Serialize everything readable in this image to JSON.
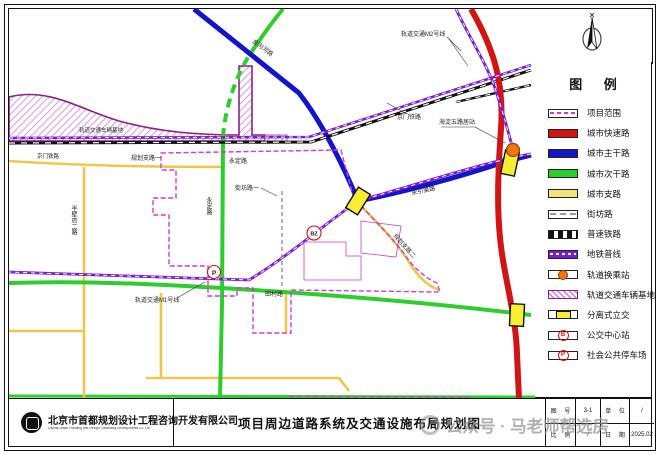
{
  "legend": {
    "title": "图 例",
    "items": [
      {
        "label": "项目范围"
      },
      {
        "label": "城市快速路"
      },
      {
        "label": "城市主干路"
      },
      {
        "label": "城市次干路"
      },
      {
        "label": "城市支路"
      },
      {
        "label": "街坊路"
      },
      {
        "label": "普速铁路"
      },
      {
        "label": "地铁普线"
      },
      {
        "label": "轨道换乘站"
      },
      {
        "label": "轨道交通车辆基地"
      },
      {
        "label": "分离式立交"
      },
      {
        "label": "公交中心站"
      },
      {
        "label": "社会公共停车场"
      }
    ],
    "bus_glyph": "B",
    "parking_glyph": "P"
  },
  "map": {
    "labels": {
      "depot": "轨道交通车辆基地",
      "railway_west": "京门铁路",
      "railway_east": "京门铁路",
      "metro_m2": "轨道交通M2号线",
      "station": "海淀五路居站",
      "jingouhe": "金沟河路",
      "yongyinqu": "永引渠路",
      "branch1": "规划支路一",
      "yongding_h": "永定路",
      "jiefang1": "街坊路一",
      "yongding_v": "永定路",
      "banbidian": "半壁店二路",
      "metro_m1": "轨道交通M1号线",
      "tiancun": "田村路",
      "branch2": "规划支路二",
      "bz": "BZ",
      "p": "P"
    }
  },
  "title_block": {
    "company_cn": "北京市首都规划设计工程咨询开发有限公司",
    "company_en": "Capital Urban Planning and Design Consulting Developments Co.,Ltd",
    "drawing_title": "项目周边道路系统及交通设施布局规划图",
    "fields": {
      "sheet_no_label": "图 号",
      "sheet_no": "3-1",
      "unit_label": "单 位",
      "unit": "/",
      "scale_label": "比 例",
      "scale": "/",
      "date_label": "日 期",
      "date": "2025.02"
    }
  },
  "watermark": {
    "text": "公众号 · 马老师帮选房"
  },
  "colors": {
    "expressway": "#d11414",
    "arterial": "#1515c8",
    "secondary": "#2ecc2e",
    "branch": "#e9c94d",
    "metro": "#7a1fd0",
    "project_boundary": "#cc3fcc",
    "railway": "#111111",
    "transfer_station": "#ee7711",
    "interchange": "#f7ee33"
  }
}
